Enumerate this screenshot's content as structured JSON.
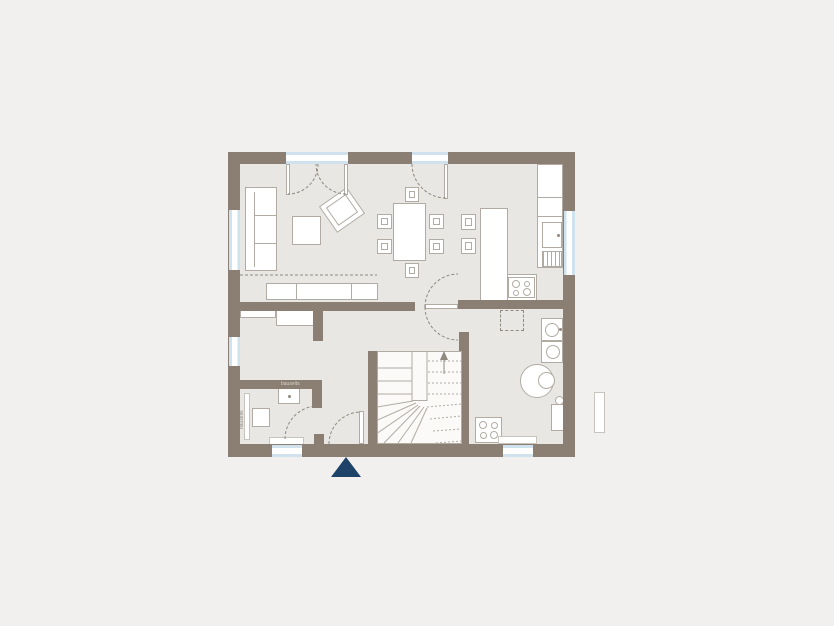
{
  "title": "Ground floor plan",
  "colors": {
    "background": "#f1f0ee",
    "floor": "#e9e7e4",
    "wall": "#8b7f73",
    "line": "#b1aba3",
    "line_dark": "#8f897f",
    "glass": "#cfe2ee",
    "stair_fill": "#fbfaf9",
    "marker": "#1f4268",
    "label": "#8f897f",
    "label_on_wall": "#d8d2ca"
  },
  "labels": {
    "wc_fixture_note": "bauseits",
    "wc_side_note": "bauseits"
  },
  "icons": {
    "entrance_marker": "triangle-up-icon",
    "stair_direction": "arrow-up-icon",
    "cooktop": "four-burner-icon",
    "sink": "square-basin-icon",
    "washer": "drum-circle-icon",
    "dryer": "drum-circle-icon",
    "boiler": "double-circle-icon"
  }
}
